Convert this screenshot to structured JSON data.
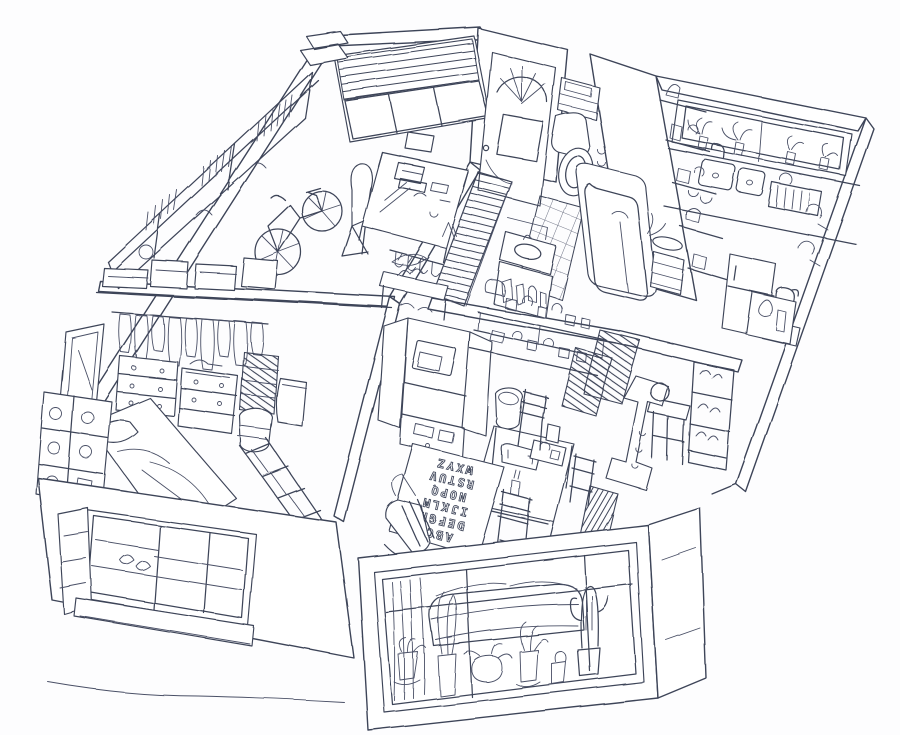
{
  "palette": {
    "ink": "#3e4459",
    "paper": "#fdfdfe"
  },
  "alphabet_mat": {
    "rows": [
      "ABC",
      "DEFGH",
      "IJKLM",
      "NOPQ",
      "RSTUV",
      "WXYZ"
    ]
  },
  "scene": {
    "type": "hand-drawn isometric cutaway sketch of a one-floor apartment, pen ink on white paper",
    "rooms": [
      {
        "name": "workshop-studio",
        "objects": [
          "window-with-venetian-blinds",
          "long-wall-bookshelves",
          "stacked-books-and-boxes",
          "bicycle",
          "lounge-chair",
          "work-desk-with-typewriter",
          "small-crate"
        ]
      },
      {
        "name": "entry-hall",
        "objects": [
          "front-door-with-arched-fan-window",
          "striped-stair-runner",
          "coat-hooks",
          "shoe-console-with-slippers"
        ]
      },
      {
        "name": "bathroom",
        "objects": [
          "toilet-with-tank",
          "towel-shelf",
          "tiled-floor",
          "bathtub",
          "hand-shower",
          "vanity-sink-with-mirror",
          "toiletry-bottles",
          "brick-wall",
          "laundry-baskets",
          "potted-plant"
        ]
      },
      {
        "name": "kitchen",
        "objects": [
          "window-with-potted-herbs",
          "double-basin-sink",
          "faucet",
          "dish-rack",
          "wall-shelves-with-jars",
          "kettle",
          "hanging-pans",
          "fridge",
          "counter"
        ]
      },
      {
        "name": "bedroom",
        "objects": [
          "open-wardrobe-hanging-clothes",
          "overhead-shelf-with-boxes",
          "three-drawer-dressers",
          "folded-clothes-stacks",
          "leaning-mirror",
          "bed-with-pillow-and-duvet",
          "display-shelf-with-dishes",
          "woven-laundry-basket",
          "waste-bin",
          "magazine-rack"
        ]
      },
      {
        "name": "dining-living",
        "objects": [
          "hutch-cabinet-with-open-doors",
          "microwave",
          "wall-shelves-with-dishes",
          "pitcher",
          "dining-table",
          "sewing-machine",
          "ladder-back-chairs",
          "alphabet-play-mat",
          "rocking-chair",
          "round-trash-bin",
          "wooden-stool",
          "shoe-rack",
          "radiator-panels",
          "vacuum-cleaner",
          "small-heater"
        ]
      },
      {
        "name": "exterior",
        "objects": [
          "bedroom-window-with-open-casement",
          "window-shelves",
          "living-room-bay-window",
          "sofa-with-cushions",
          "curtains",
          "row-of-potted-plants",
          "tall-cactus",
          "ground-line"
        ]
      }
    ]
  }
}
